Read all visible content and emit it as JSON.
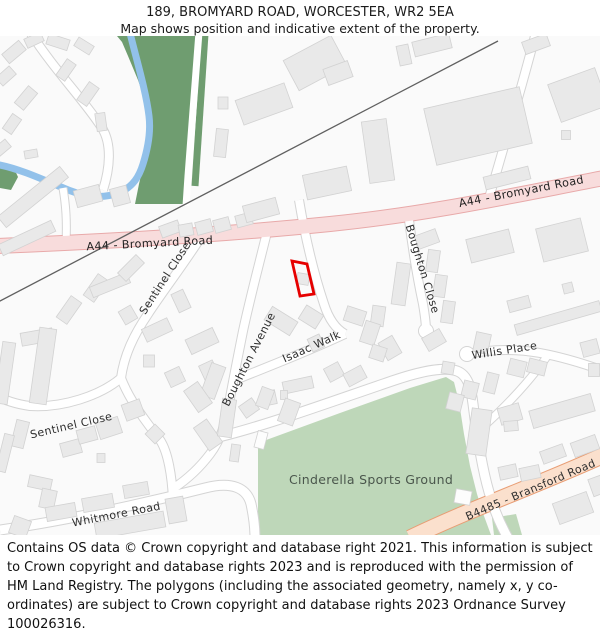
{
  "title": {
    "line1": "189, BROMYARD ROAD, WORCESTER, WR2 5EA",
    "line2": "Map shows position and indicative extent of the property."
  },
  "footer": {
    "text": "Contains OS data © Crown copyright and database right 2021. This information is subject to Crown copyright and database rights 2023 and is reproduced with the permission of HM Land Registry. The polygons (including the associated geometry, namely x, y co-ordinates) are subject to Crown copyright and database rights 2023 Ordnance Survey 100026316."
  },
  "map": {
    "labels": {
      "a44_west": "A44 - Bromyard Road",
      "a44_east": "A44 - Bromyard Road",
      "sentinel_upper": "Sentinel Close",
      "sentinel_lower": "Sentinel Close",
      "boughton_avenue": "Boughton Avenue",
      "boughton_close": "Boughton Close",
      "isaac_walk": "Isaac Walk",
      "willis_place": "Willis Place",
      "whitmore_road": "Whitmore Road",
      "sports_ground": "Cinderella Sports Ground",
      "b4485": "B4485 - Bransford Road"
    },
    "colors": {
      "map_bg": "#fafafa",
      "woodland": "#6f9d70",
      "sports_green": "#bed7b9",
      "river": "#92c1ea",
      "road_fill": "#ffffff",
      "road_casing": "#d4d4d4",
      "a_road_fill": "#f8dcdc",
      "a_road_casing": "#e8a9a9",
      "b_road_fill": "#fbe0cd",
      "b_road_casing": "#e89d74",
      "building_fill": "#e9e9e9",
      "building_stroke": "#d2d2d2",
      "railway": "#606060",
      "property_outline": "#e60000"
    },
    "railway": {
      "d": "M -2,266 L 498,5"
    },
    "greens": [
      "113,0 197,0 193,50 190,100 187,140 184,168 135,168 139,148 146,118 150,92 147,70 138,44 128,20 122,6 117,0",
      "0,126 13,130 18,141 11,154 0,152",
      "258,407 340,377 410,352 446,341 454,346 459,366 464,398 470,430 477,458 484,480 491,499 258,499",
      "492,482 516,478 522,499 494,499"
    ],
    "green_types": [
      "woodland",
      "woodland",
      "sports",
      "sports"
    ],
    "green_strip": {
      "d": "M 205,-2 C 201,55 198,105 195,150"
    },
    "river": {
      "d": "M 130,-3 C 136,22 146,55 149,80 C 151,96 148,112 143,128 C 139,141 133,150 121,156 C 99,165 79,159 61,151 C 44,144 20,133 0,129"
    },
    "roads": [
      {
        "type": "minor",
        "w": 8,
        "d": "M 30,-4 C 55,35 85,65 102,92 C 112,108 110,132 103,154"
      },
      {
        "type": "minor",
        "w": 7,
        "d": "M 63,152 C 66,170 67,185 66,208"
      },
      {
        "type": "path",
        "w": 5,
        "d": "M 199,-4 C 195,50 191,100 188,140 L 186,170"
      },
      {
        "type": "minor",
        "w": 8,
        "d": "M 208,190 C 190,220 165,252 148,278 C 133,300 124,320 121,342"
      },
      {
        "type": "minor",
        "w": 8,
        "d": "M 121,342 C 100,360 62,372 30,370 C 15,368 5,364 -4,360"
      },
      {
        "type": "minor",
        "w": 8,
        "d": "M 121,342 C 130,366 148,388 160,404 C 168,416 172,440 173,464"
      },
      {
        "type": "minor",
        "w": 9,
        "d": "M 0,494 C 70,484 150,466 205,452 C 232,445 247,452 251,468 C 254,482 255,492 255,502"
      },
      {
        "type": "minor",
        "w": 8,
        "d": "M 268,192 C 260,225 250,262 243,295 C 237,325 233,345 230,362 C 226,388 220,405 210,418 C 198,434 186,444 174,452"
      },
      {
        "type": "minor",
        "w": 8,
        "d": "M 299,164 C 305,200 314,238 324,268 C 329,284 336,293 345,298"
      },
      {
        "type": "minor",
        "w": 8,
        "d": "M 345,298 C 315,312 280,326 240,342"
      },
      {
        "type": "minor",
        "w": 8,
        "d": "M 409,184 C 413,215 418,245 423,268 C 425,280 426,288 426,294"
      },
      {
        "type": "minor",
        "w": 9,
        "d": "M 210,403 C 260,392 330,366 395,344 C 425,334 445,331 457,335 C 468,339 471,352 473,368 C 477,400 482,432 489,456 C 494,474 500,488 508,502"
      },
      {
        "type": "minor",
        "w": 8,
        "d": "M 467,318 C 492,313 518,313 540,317 C 562,321 582,327 604,335"
      },
      {
        "type": "minor",
        "w": 7,
        "d": "M 548,319 C 530,345 506,370 484,390"
      },
      {
        "type": "minor",
        "w": 8,
        "d": "M 489,162 C 497,135 510,90 522,48 C 527,30 532,12 536,-4"
      },
      {
        "type": "major_a",
        "w": 14,
        "d": "M -4,210 C 120,205 240,197 330,188 C 430,178 520,158 604,142"
      },
      {
        "type": "major_b",
        "w": 15,
        "d": "M 410,502 C 470,473 540,448 604,419"
      }
    ],
    "bulbs": [
      [
        426,
        295
      ],
      [
        467,
        318
      ]
    ],
    "buildings": [
      [
        14,
        16,
        22,
        12,
        -40
      ],
      [
        34,
        4,
        18,
        10,
        -25
      ],
      [
        6,
        40,
        18,
        11,
        -42
      ],
      [
        26,
        62,
        22,
        12,
        -50
      ],
      [
        12,
        88,
        18,
        11,
        -55
      ],
      [
        2,
        112,
        16,
        10,
        -40
      ],
      [
        58,
        6,
        22,
        11,
        18
      ],
      [
        84,
        10,
        18,
        10,
        32
      ],
      [
        66,
        34,
        20,
        11,
        -55
      ],
      [
        88,
        58,
        22,
        12,
        -55
      ],
      [
        101,
        86,
        10,
        18,
        -8
      ],
      [
        33,
        161,
        80,
        14,
        -39
      ],
      [
        27,
        202,
        58,
        12,
        -25
      ],
      [
        31,
        118,
        13,
        8,
        -10
      ],
      [
        88,
        160,
        26,
        17,
        -15
      ],
      [
        120,
        160,
        17,
        18,
        -15
      ],
      [
        223,
        67,
        10,
        12,
        0
      ],
      [
        221,
        107,
        12,
        28,
        6
      ],
      [
        170,
        193,
        20,
        12,
        -20
      ],
      [
        186,
        194,
        14,
        12,
        -10
      ],
      [
        204,
        191,
        16,
        13,
        -15
      ],
      [
        222,
        189,
        16,
        13,
        -15
      ],
      [
        244,
        184,
        16,
        12,
        -15
      ],
      [
        261,
        174,
        34,
        17,
        -15
      ],
      [
        327,
        147,
        45,
        25,
        -12
      ],
      [
        264,
        68,
        52,
        26,
        -20
      ],
      [
        315,
        27,
        54,
        34,
        -28
      ],
      [
        404,
        19,
        12,
        20,
        -12
      ],
      [
        432,
        9,
        38,
        15,
        -14
      ],
      [
        338,
        37,
        26,
        17,
        -20
      ],
      [
        536,
        8,
        26,
        13,
        -20
      ],
      [
        578,
        59,
        50,
        40,
        -20
      ],
      [
        378,
        115,
        25,
        62,
        -8
      ],
      [
        478,
        90,
        98,
        58,
        -13
      ],
      [
        507,
        142,
        46,
        13,
        -14
      ],
      [
        566,
        99,
        9,
        9,
        0
      ],
      [
        490,
        210,
        44,
        24,
        -14
      ],
      [
        562,
        204,
        46,
        34,
        -14
      ],
      [
        568,
        252,
        10,
        10,
        -14
      ],
      [
        427,
        203,
        22,
        14,
        -20
      ],
      [
        401,
        248,
        14,
        42,
        8
      ],
      [
        433,
        225,
        12,
        22,
        8
      ],
      [
        440,
        250,
        12,
        22,
        8
      ],
      [
        448,
        276,
        12,
        22,
        8
      ],
      [
        434,
        304,
        20,
        15,
        -30
      ],
      [
        390,
        312,
        16,
        20,
        -30
      ],
      [
        378,
        280,
        13,
        20,
        8
      ],
      [
        355,
        280,
        20,
        15,
        18
      ],
      [
        370,
        297,
        15,
        22,
        18
      ],
      [
        378,
        317,
        15,
        14,
        18
      ],
      [
        281,
        285,
        16,
        30,
        -58
      ],
      [
        311,
        281,
        16,
        20,
        -58
      ],
      [
        316,
        307,
        13,
        14,
        -25
      ],
      [
        303,
        243,
        12,
        11,
        10
      ],
      [
        96,
        252,
        26,
        13,
        -55
      ],
      [
        69,
        274,
        26,
        13,
        -55
      ],
      [
        128,
        279,
        14,
        15,
        -30
      ],
      [
        157,
        294,
        28,
        14,
        -25
      ],
      [
        181,
        265,
        13,
        20,
        -25
      ],
      [
        202,
        305,
        30,
        16,
        -25
      ],
      [
        149,
        325,
        11,
        12,
        0
      ],
      [
        175,
        341,
        16,
        16,
        -25
      ],
      [
        210,
        337,
        15,
        22,
        -25
      ],
      [
        110,
        249,
        40,
        11,
        -22
      ],
      [
        131,
        232,
        26,
        12,
        -45
      ],
      [
        37,
        301,
        32,
        13,
        -10
      ],
      [
        5,
        337,
        13,
        62,
        8
      ],
      [
        43,
        330,
        17,
        76,
        8
      ],
      [
        334,
        336,
        16,
        15,
        -28
      ],
      [
        355,
        340,
        20,
        14,
        -28
      ],
      [
        298,
        349,
        30,
        12,
        -12
      ],
      [
        269,
        362,
        14,
        14,
        -12
      ],
      [
        249,
        372,
        16,
        14,
        -35
      ],
      [
        284,
        359,
        7,
        9,
        0
      ],
      [
        213,
        345,
        15,
        34,
        20
      ],
      [
        519,
        268,
        22,
        12,
        -15
      ],
      [
        558,
        282,
        88,
        11,
        -16
      ],
      [
        482,
        307,
        15,
        20,
        12
      ],
      [
        590,
        312,
        17,
        15,
        -15
      ],
      [
        448,
        332,
        12,
        12,
        10
      ],
      [
        470,
        354,
        15,
        17,
        14
      ],
      [
        491,
        347,
        12,
        20,
        14
      ],
      [
        517,
        332,
        17,
        16,
        14
      ],
      [
        537,
        331,
        18,
        14,
        14
      ],
      [
        594,
        334,
        11,
        13,
        0
      ],
      [
        455,
        366,
        15,
        17,
        14
      ],
      [
        562,
        375,
        64,
        18,
        -16
      ],
      [
        510,
        378,
        22,
        17,
        -16
      ],
      [
        479,
        396,
        20,
        46,
        8
      ],
      [
        553,
        418,
        24,
        13,
        -20
      ],
      [
        585,
        410,
        26,
        15,
        -20
      ],
      [
        508,
        436,
        18,
        13,
        -12
      ],
      [
        530,
        437,
        20,
        13,
        -12
      ],
      [
        511,
        390,
        14,
        10,
        -5
      ],
      [
        573,
        472,
        36,
        22,
        -20
      ],
      [
        597,
        450,
        13,
        18,
        -20
      ],
      [
        198,
        361,
        17,
        26,
        -35
      ],
      [
        208,
        399,
        16,
        28,
        -35
      ],
      [
        227,
        382,
        14,
        38,
        8
      ],
      [
        235,
        417,
        9,
        17,
        8
      ],
      [
        265,
        362,
        13,
        20,
        20
      ],
      [
        289,
        376,
        16,
        24,
        20
      ],
      [
        71,
        412,
        20,
        14,
        -15
      ],
      [
        87,
        399,
        19,
        14,
        -15
      ],
      [
        109,
        392,
        23,
        17,
        -18
      ],
      [
        133,
        374,
        19,
        17,
        -20
      ],
      [
        155,
        398,
        14,
        14,
        -45
      ],
      [
        101,
        422,
        8,
        9,
        0
      ],
      [
        20,
        398,
        13,
        27,
        14
      ],
      [
        5,
        417,
        10,
        38,
        14
      ],
      [
        40,
        447,
        23,
        12,
        12
      ],
      [
        48,
        463,
        15,
        19,
        12
      ],
      [
        61,
        476,
        30,
        14,
        -10
      ],
      [
        98,
        467,
        31,
        14,
        -10
      ],
      [
        136,
        454,
        25,
        13,
        -10
      ],
      [
        20,
        491,
        18,
        18,
        20
      ],
      [
        130,
        489,
        70,
        16,
        -10
      ],
      [
        176,
        474,
        18,
        25,
        -10
      ]
    ],
    "white_buildings": [
      [
        463,
        461,
        16,
        14,
        10
      ],
      [
        261,
        404,
        10,
        17,
        15
      ]
    ],
    "property_outline_points": "292,225 307,228 314,258 300,260"
  }
}
